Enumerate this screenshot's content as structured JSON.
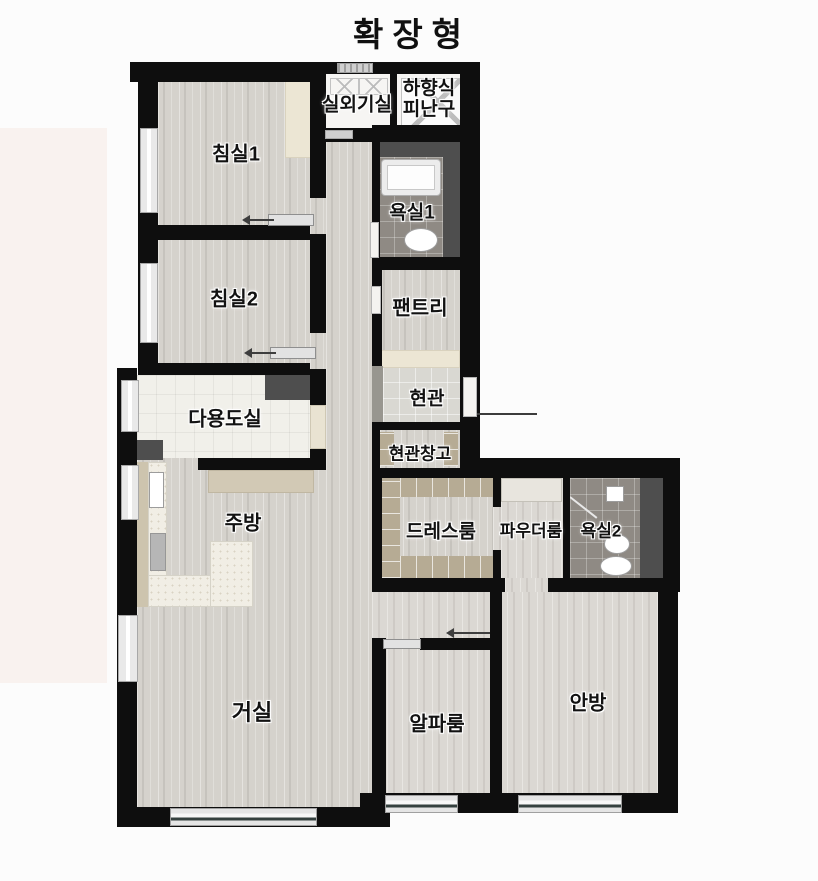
{
  "title": "확장형",
  "rooms": {
    "bedroom1": "침실1",
    "bedroom2": "침실2",
    "outdoor_unit": "실외기실",
    "hatch_line1": "하향식",
    "hatch_line2": "피난구",
    "bath1": "욕실1",
    "pantry": "팬트리",
    "utility": "다용도실",
    "entry": "현관",
    "entry_storage": "현관창고",
    "kitchen": "주방",
    "dress": "드레스룸",
    "powder": "파우더룸",
    "bath2": "욕실2",
    "living": "거실",
    "alpha": "알파룸",
    "master": "안방"
  },
  "colors": {
    "wall": "#0e0e0e",
    "wood_floor": "#d5d2cc",
    "bath_tile": "#8f8a84",
    "closet_tan": "#b6ab94",
    "accent_pink_band": "#f9f2ef"
  }
}
